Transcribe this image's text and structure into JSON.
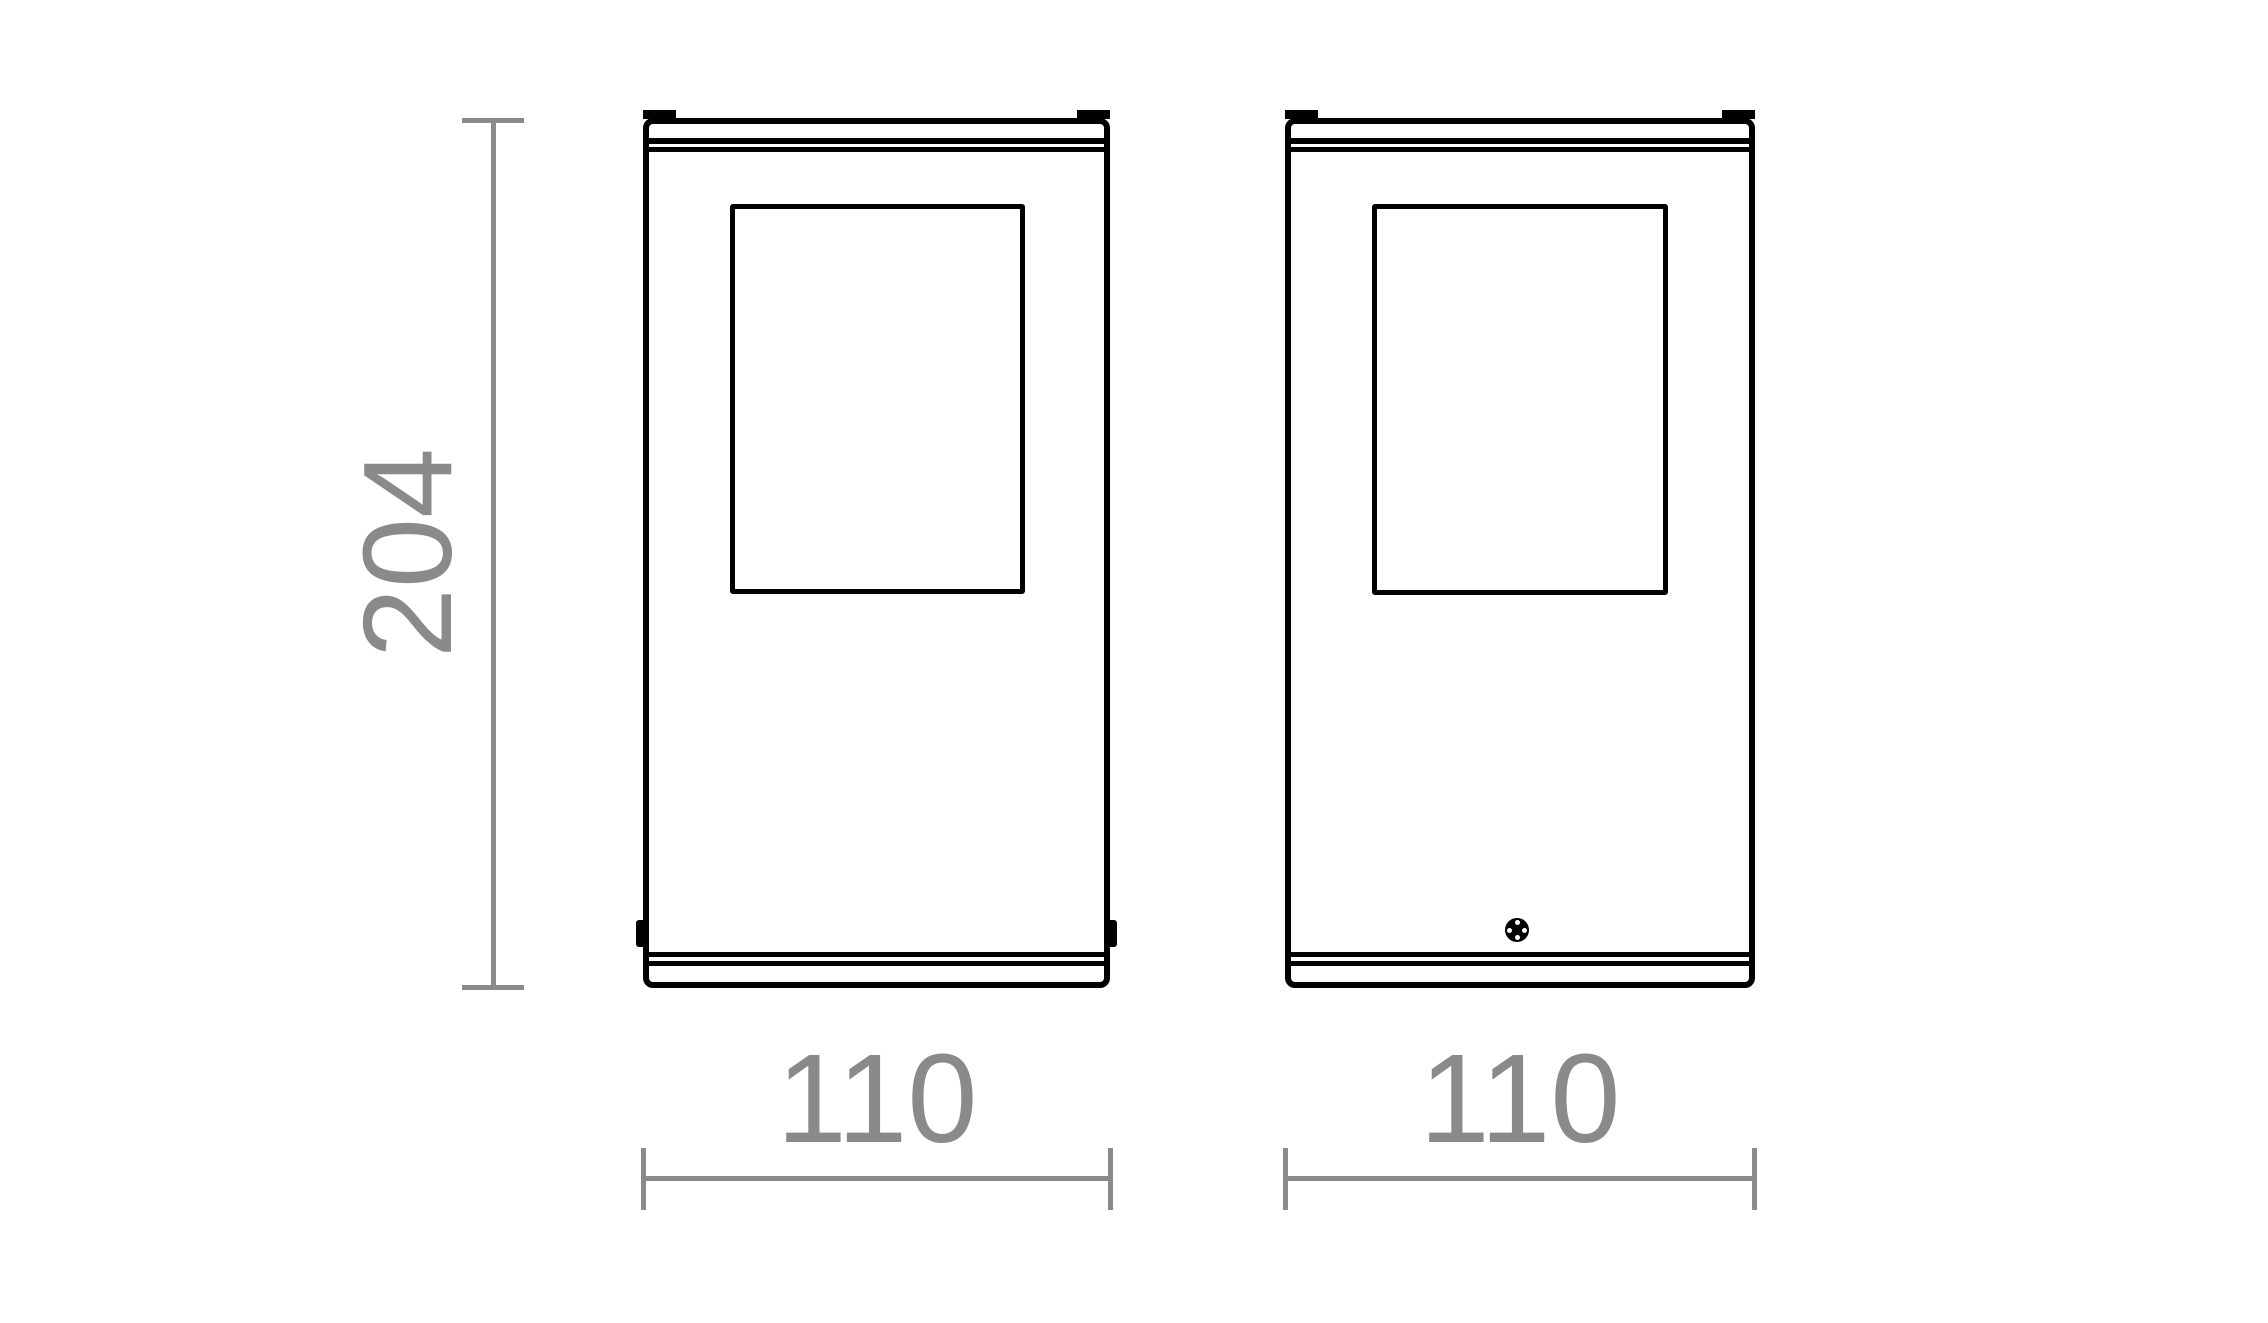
{
  "colors": {
    "background": "#ffffff",
    "outline": "#000000",
    "dimension": "#8a8a8a"
  },
  "dimensions": {
    "height_label": "204",
    "front_width_label": "110",
    "side_width_label": "110"
  },
  "icons": {
    "screw": "filled-circle-with-four-cross-holes"
  }
}
